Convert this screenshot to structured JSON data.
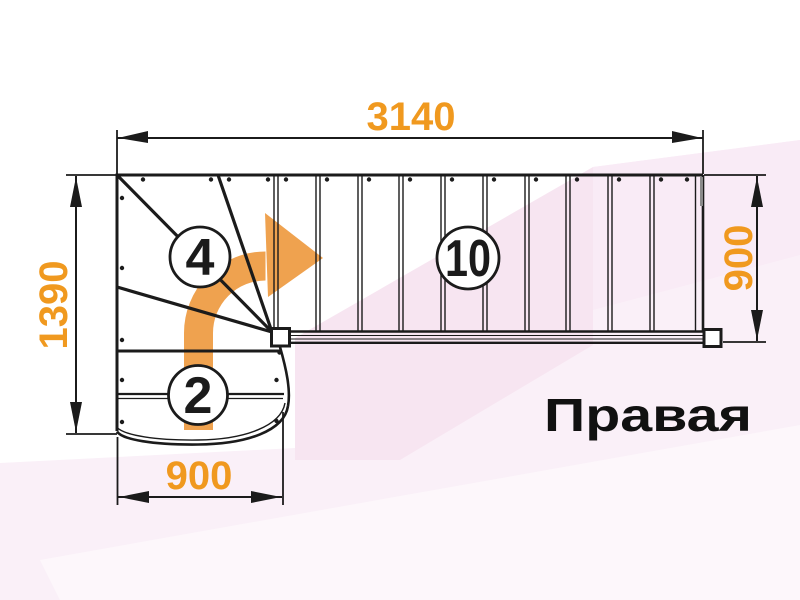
{
  "title": {
    "text": "Правая"
  },
  "dimensions": {
    "top_width": "3140",
    "left_height": "1390",
    "bottom_width": "900",
    "right_height": "900"
  },
  "step_counts": {
    "winder_steps": "4",
    "straight_steps": "10",
    "bottom_steps": "2"
  },
  "colors": {
    "dimension_text": "#f0991f",
    "arrow_fill": "#efa24f",
    "line": "#1b1b1b",
    "title_text": "#111111",
    "bg_pink_base": "#faf0f8",
    "bg_pink_mid": "#f7e5f1",
    "bg_pink_soft": "#f9ebf6",
    "bg_pink_light": "#fdf7fb"
  }
}
